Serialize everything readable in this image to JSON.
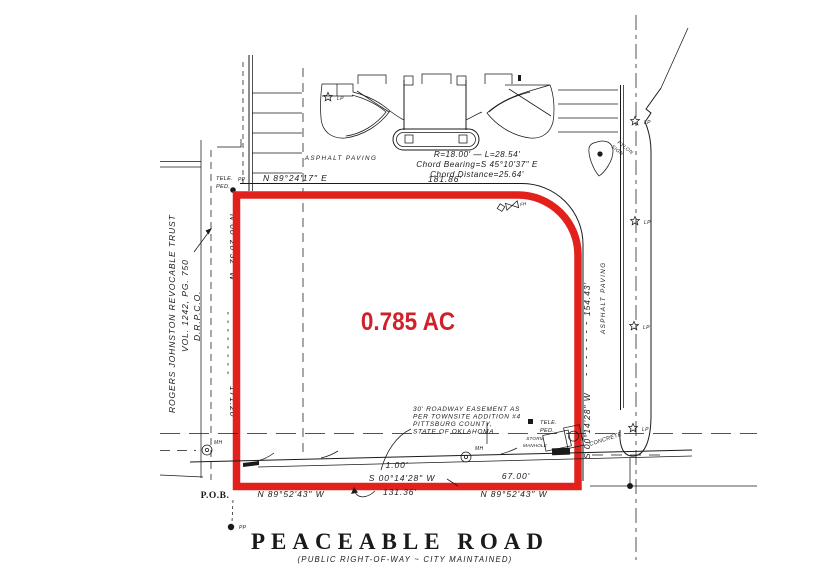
{
  "colors": {
    "boundary_red": "#E3211C",
    "area_red": "#D0202A",
    "ink": "#1A1A1A"
  },
  "parcel": {
    "area": "0.785 AC",
    "pob": "P.O.B."
  },
  "dimensions": {
    "north_bearing": "N 89°24'17\" E",
    "north_distance": "181.86'",
    "west_bearing": "N 00°20'32\" W",
    "west_distance": "171.20'",
    "east_bearing": "S 00°14'28\" W",
    "east_distance": "154.43'",
    "south_left_bearing": "N 89°52'43\" W",
    "south_left_distance": "131.36'",
    "south_right_bearing": "N 89°52'43\" W",
    "south_right_distance": "67.00'",
    "jog_bearing": "S 00°14'28\" W",
    "jog_distance": "1.00'"
  },
  "curve": {
    "radius_length": "R=18.00'  —  L=28.54'",
    "chord_bearing": "Chord Bearing=S 45°10'37\" E",
    "chord_distance": "Chord Distance=25.64'"
  },
  "neighbor": {
    "line1": "ROGERS JOHNSTON REVOCABLE TRUST",
    "line2": "VOL. 1242, PG. 750",
    "line3": "D.R.P.C.O."
  },
  "easement_note": {
    "line1": "30' ROADWAY EASEMENT AS",
    "line2": "PER TOWNSITE ADDITION #4",
    "line3": "PITTSBURG COUNTY,",
    "line4": "STATE OF OKLAHOMA"
  },
  "road": {
    "name": "PEACEABLE ROAD",
    "subtitle": "(PUBLIC RIGHT-OF-WAY ~ CITY MAINTAINED)"
  },
  "labels": {
    "asphalt_paving": "ASPHALT PAVING",
    "concrete": "CONCRETE",
    "pylon_line1": "PYLON",
    "pylon_line2": "SIGN",
    "tele_line1": "TELE.",
    "tele_line2": "PED.",
    "storm_line1": "STORM",
    "storm_line2": "MANHOLE",
    "mh": "MH",
    "pp": "PP",
    "lp": "LP",
    "fh": "FH",
    "wv": "WV"
  }
}
